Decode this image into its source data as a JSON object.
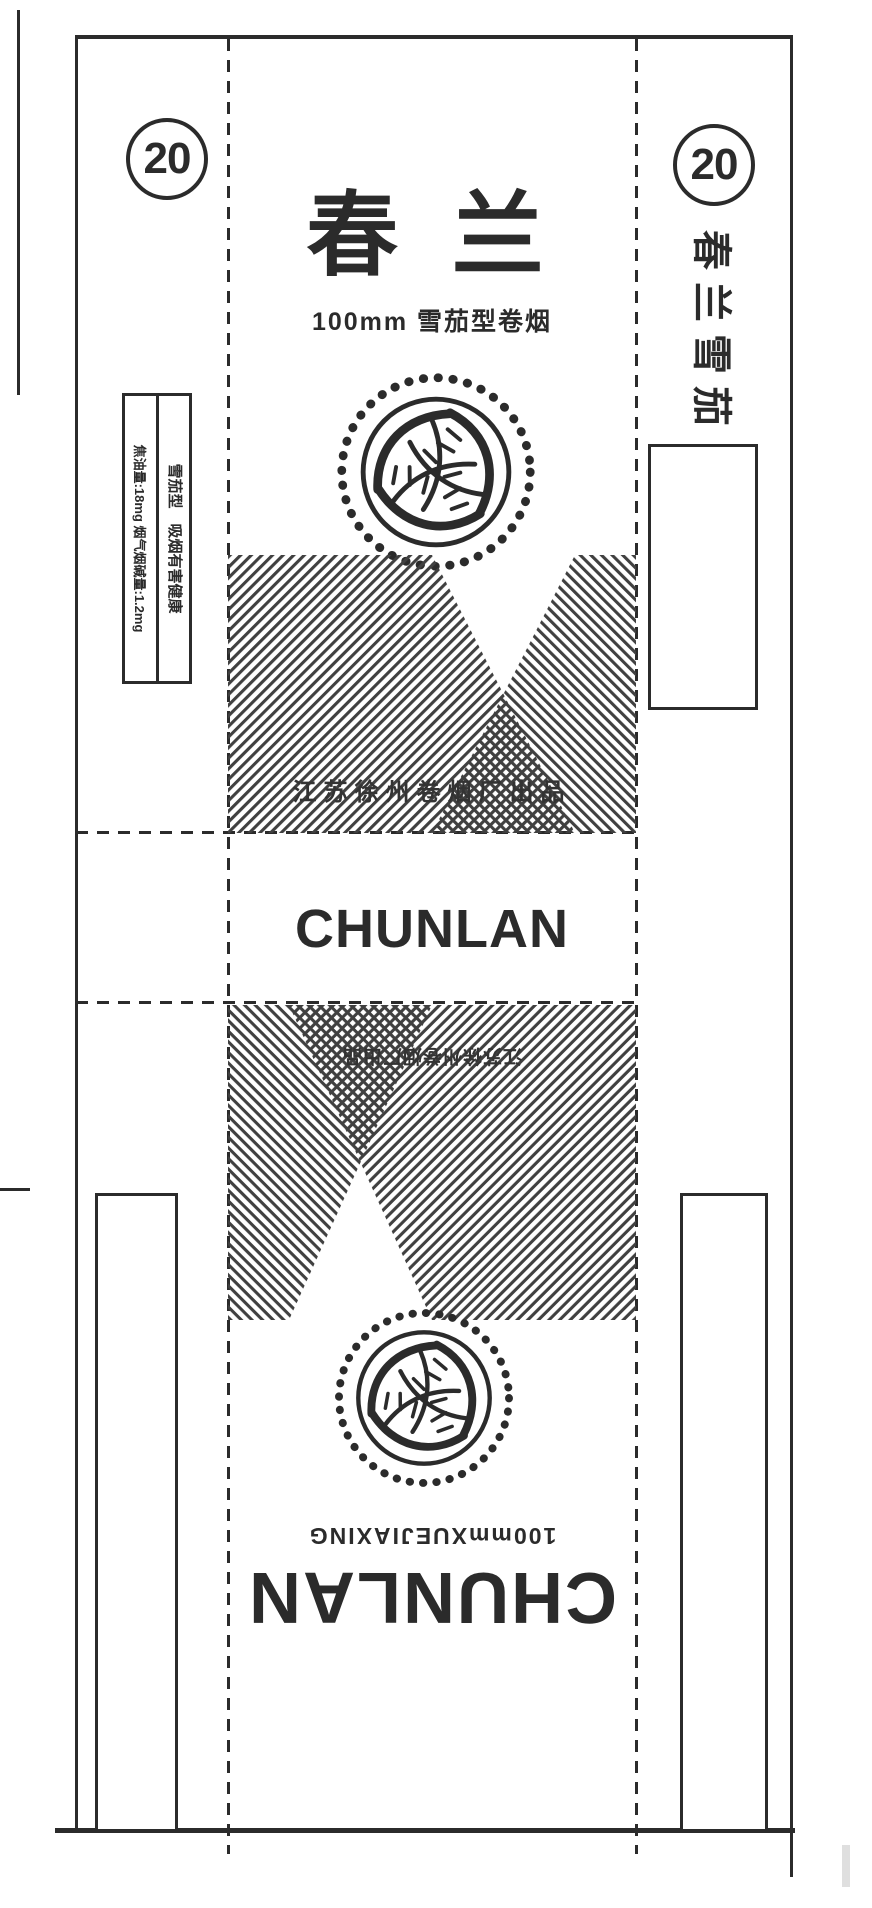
{
  "colors": {
    "ink": "#2b2b2b",
    "stripe": "#404040",
    "paper": "#ffffff"
  },
  "front": {
    "pack_count": "20",
    "brand_cn": "春 兰",
    "spec_cn": "100mm 雪茄型卷烟",
    "factory_cn": "江苏徐州卷烟厂出品"
  },
  "bottom_panel": {
    "brand_latin": "CHUNLAN"
  },
  "back": {
    "factory_cn": "江苏徐州卷烟厂出品",
    "spec_latin": "100mmXUEJIAXING",
    "brand_latin": "CHUNLAN"
  },
  "left_side": {
    "type_warning": "雪茄型　吸烟有害健康",
    "tar_info": "焦油量:18mg 烟气烟碱量:1.2mg"
  },
  "right_side": {
    "pack_count": "20",
    "brand_vertical": "春兰雪茄",
    "dimensions": "21.6×8"
  }
}
